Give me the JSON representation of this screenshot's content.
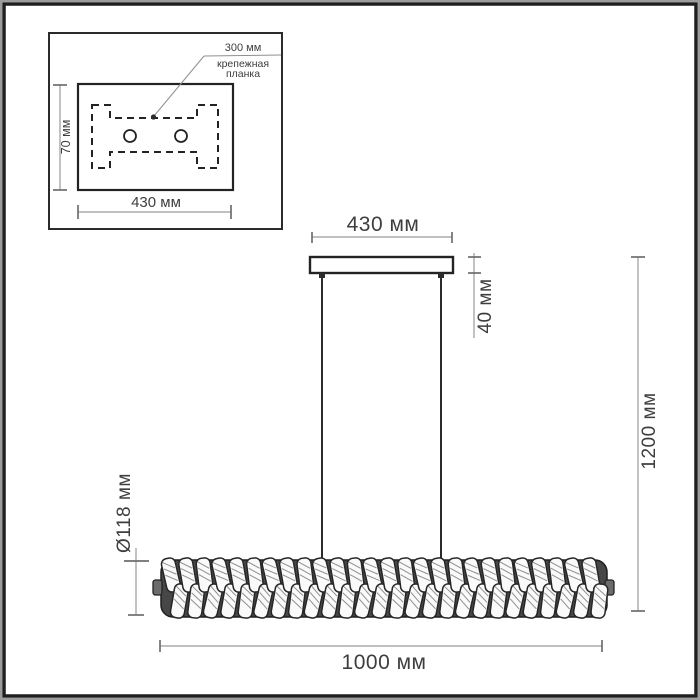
{
  "inset": {
    "plate_width_label": "430 мм",
    "plate_depth_label": "70 мм",
    "holes_span_label": "300 мм",
    "bracket_caption_line1": "крепежная",
    "bracket_caption_line2": "планка"
  },
  "drawing": {
    "canopy_width_label": "430 мм",
    "canopy_height_label": "40 мм",
    "overall_height_label": "1200 мм",
    "body_diameter_label": "Ø118 мм",
    "body_length_label": "1000 мм"
  },
  "colors": {
    "outline": "#232323",
    "dimension_line": "#9a9a9a",
    "text": "#3e3e3e",
    "bar_dark": "#474747",
    "frame": "#1f1f1f",
    "frame_outer": "#9c9c9c",
    "background": "#ffffff"
  }
}
